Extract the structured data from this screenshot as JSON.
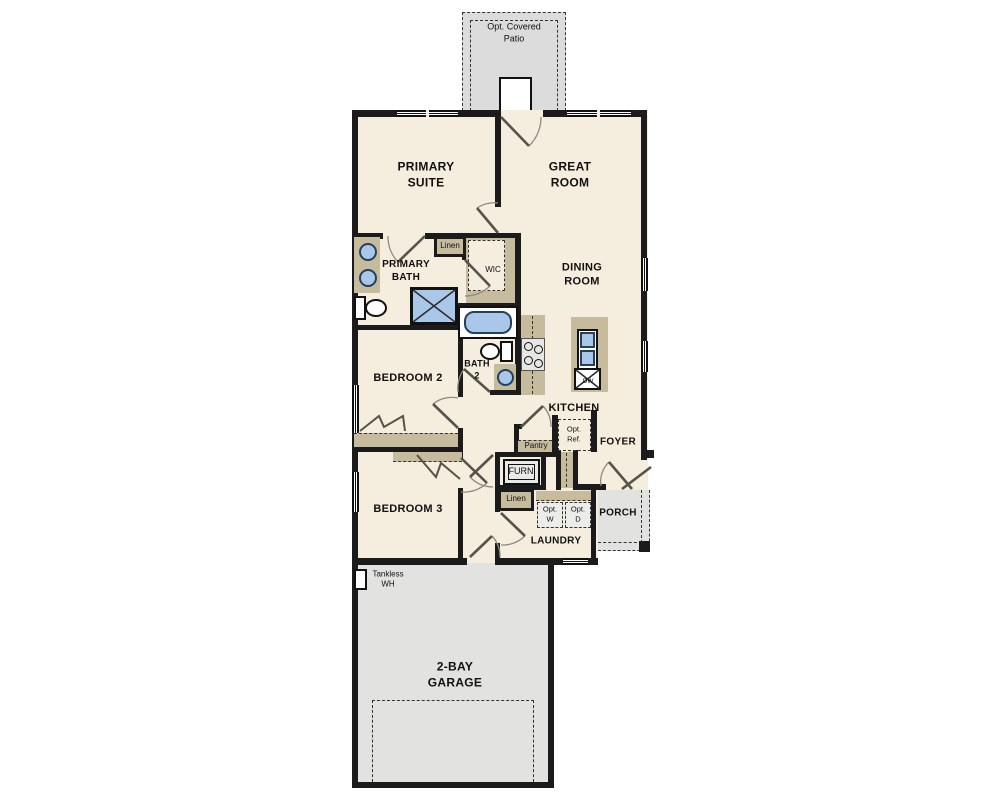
{
  "colors": {
    "floor": "#f5eede",
    "wall": "#1b1b1b",
    "cabinet_tan": "#c7bb9d",
    "fixture_blue": "#a9c7e9",
    "garage_gray": "#e2e2e0",
    "patio_gray": "#dcdcdc"
  },
  "rooms": {
    "patio": "Opt. Covered\nPatio",
    "primary_suite": "PRIMARY\nSUITE",
    "great_room": "GREAT\nROOM",
    "primary_bath": "PRIMARY\nBATH",
    "wic": "WIC",
    "dining": "DINING\nROOM",
    "bedroom2": "BEDROOM 2",
    "bath2": "BATH\n2",
    "kitchen": "KITCHEN",
    "foyer": "FOYER",
    "laundry": "LAUNDRY",
    "porch": "PORCH",
    "bedroom3": "BEDROOM 3",
    "garage": "2-BAY\nGARAGE"
  },
  "closets": {
    "linen_top": "Linen",
    "linen_bottom": "Linen",
    "pantry": "Pantry"
  },
  "equipment": {
    "furnace": "FURN",
    "dishwasher": "DW",
    "tankless": "Tankless\nWH",
    "opt_ref": "Opt.\nRef.",
    "opt_washer": "Opt.\nW",
    "opt_dryer": "Opt.\nD"
  }
}
